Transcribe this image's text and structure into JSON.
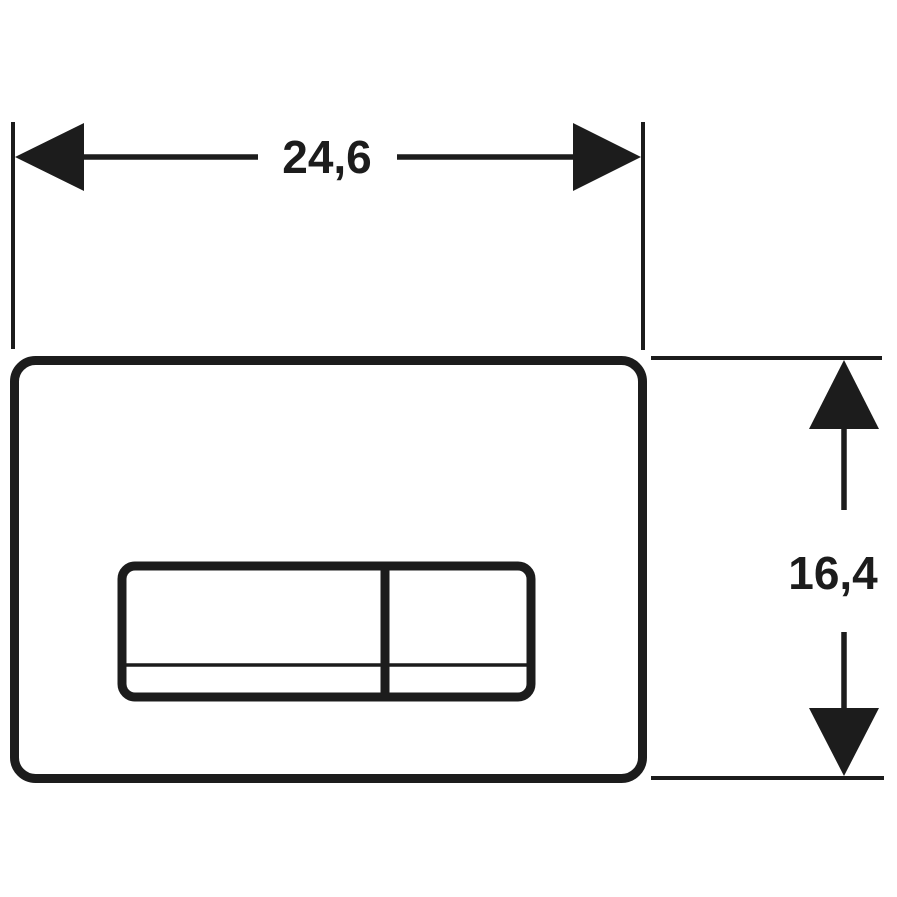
{
  "drawing": {
    "subject": "flush-plate-technical-drawing",
    "width_dimension": {
      "label": "24,6"
    },
    "height_dimension": {
      "label": "16,4"
    }
  },
  "colors": {
    "ink": "#1c1c1c",
    "background": "#ffffff"
  }
}
